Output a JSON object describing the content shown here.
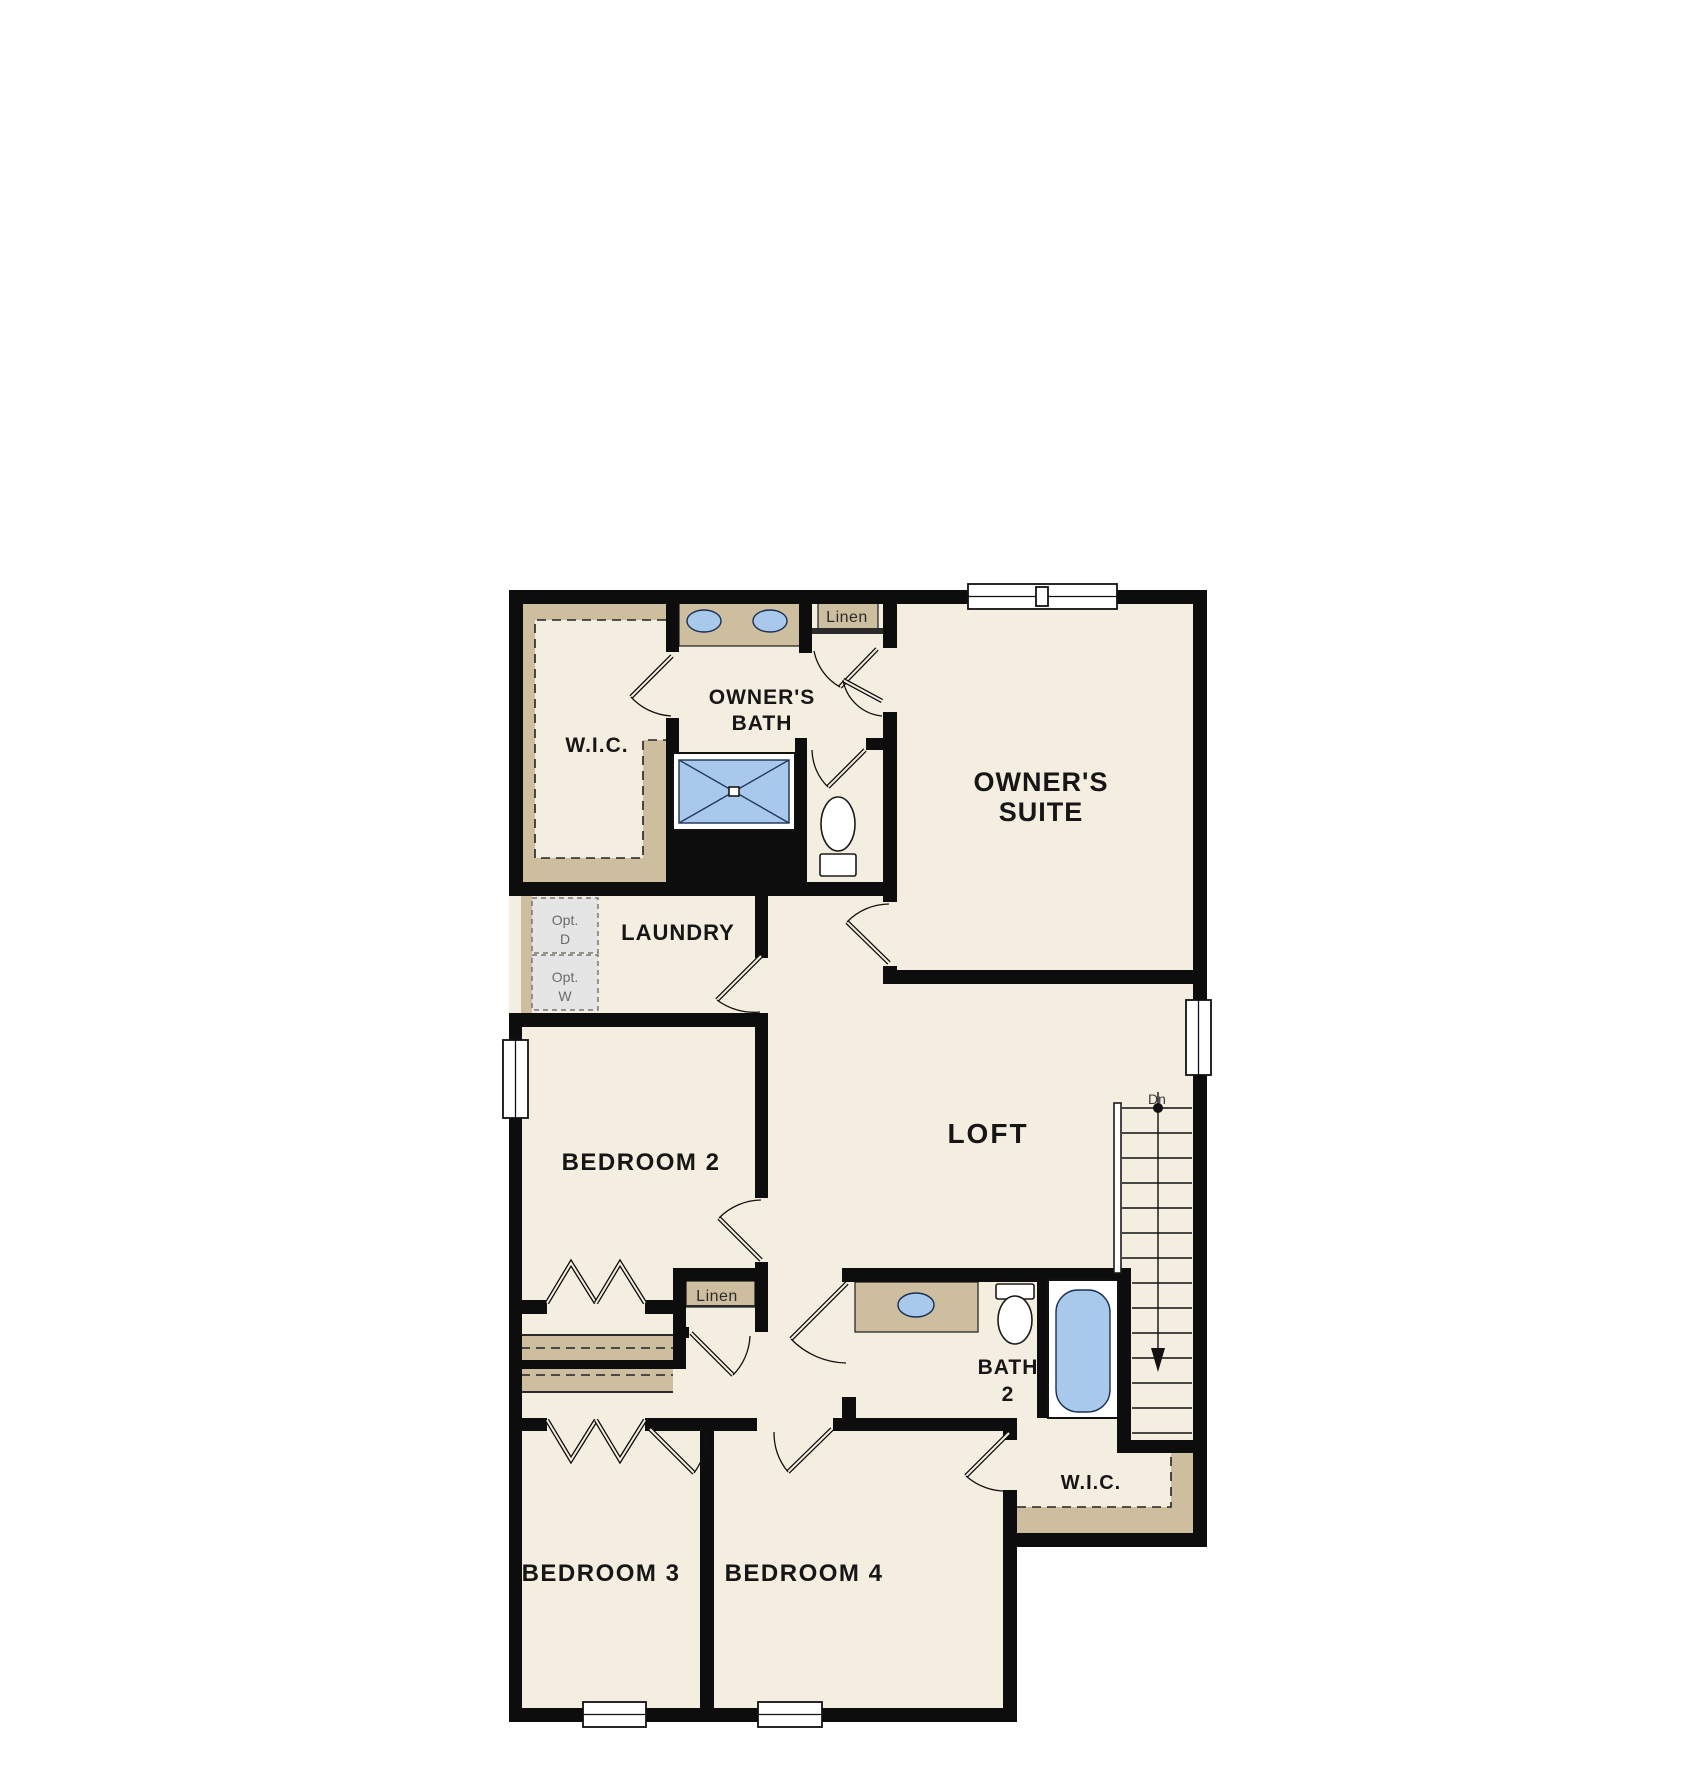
{
  "title": "Second Floor Plan",
  "colors": {
    "floor": "#f3eee0",
    "wall": "#0d0d0d",
    "casework_tan": "#cdbe9f",
    "fixture_blue": "#a9c9ec",
    "background": "#ffffff"
  },
  "rooms": {
    "wic_top": {
      "label": "W.I.C."
    },
    "owners_bath": {
      "line1": "OWNER'S",
      "line2": "BATH"
    },
    "owners_suite": {
      "line1": "OWNER'S",
      "line2": "SUITE"
    },
    "linen_top": {
      "label": "Linen"
    },
    "laundry": {
      "label": "LAUNDRY"
    },
    "opt_dryer": {
      "line1": "Opt.",
      "line2": "D"
    },
    "opt_washer": {
      "line1": "Opt.",
      "line2": "W"
    },
    "bedroom2": {
      "label": "BEDROOM 2"
    },
    "loft": {
      "label": "LOFT"
    },
    "stairs": {
      "down_label": "Dn"
    },
    "linen_mid": {
      "label": "Linen"
    },
    "bath2": {
      "line1": "BATH",
      "line2": "2"
    },
    "wic_bottom": {
      "label": "W.I.C."
    },
    "bedroom3": {
      "label": "BEDROOM 3"
    },
    "bedroom4": {
      "label": "BEDROOM 4"
    }
  }
}
